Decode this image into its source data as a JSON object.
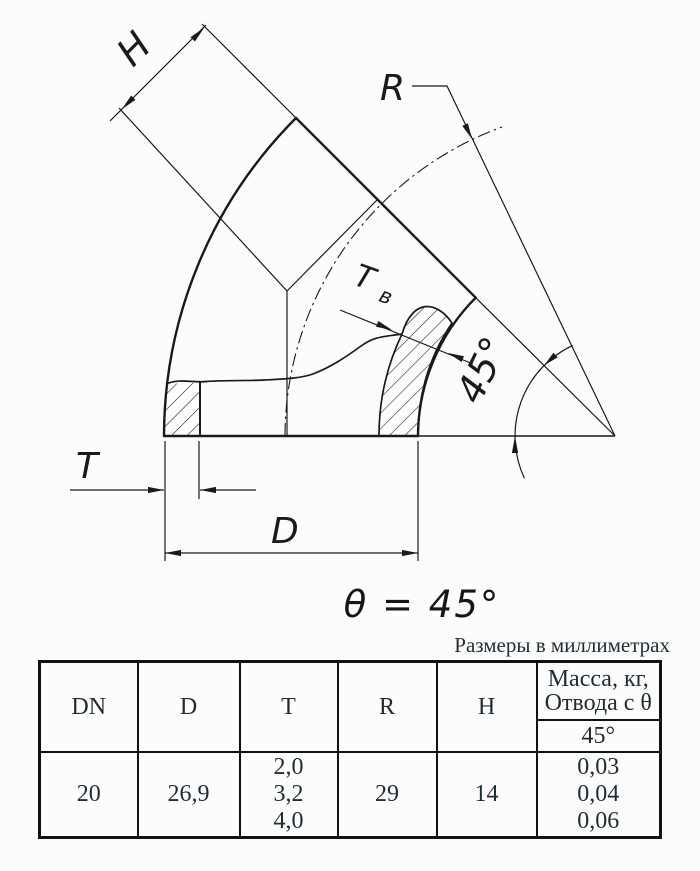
{
  "drawing": {
    "h_label": "H",
    "r_label": "R",
    "tv_main": "T",
    "tv_sub": "в",
    "angle_label": "45°",
    "t_label": "T",
    "d_label": "D",
    "theta_equation": "θ = 45°"
  },
  "table": {
    "units_note": "Размеры в миллиметрах",
    "headers": {
      "dn": "DN",
      "d": "D",
      "t": "T",
      "r": "R",
      "h": "H"
    },
    "mass_header_line1": "Масса, кг,",
    "mass_header_line2": "Отвода с θ",
    "mass_angle": "45°",
    "row": {
      "dn": "20",
      "d": "26,9",
      "t": [
        "2,0",
        "3,2",
        "4,0"
      ],
      "r": "29",
      "h": "14",
      "mass": [
        "0,03",
        "0,04",
        "0,06"
      ]
    }
  },
  "colors": {
    "ink": "#1a1a1a",
    "table_border": "#111111",
    "table_text": "#1f2d33",
    "background": "#fcfcfc"
  }
}
